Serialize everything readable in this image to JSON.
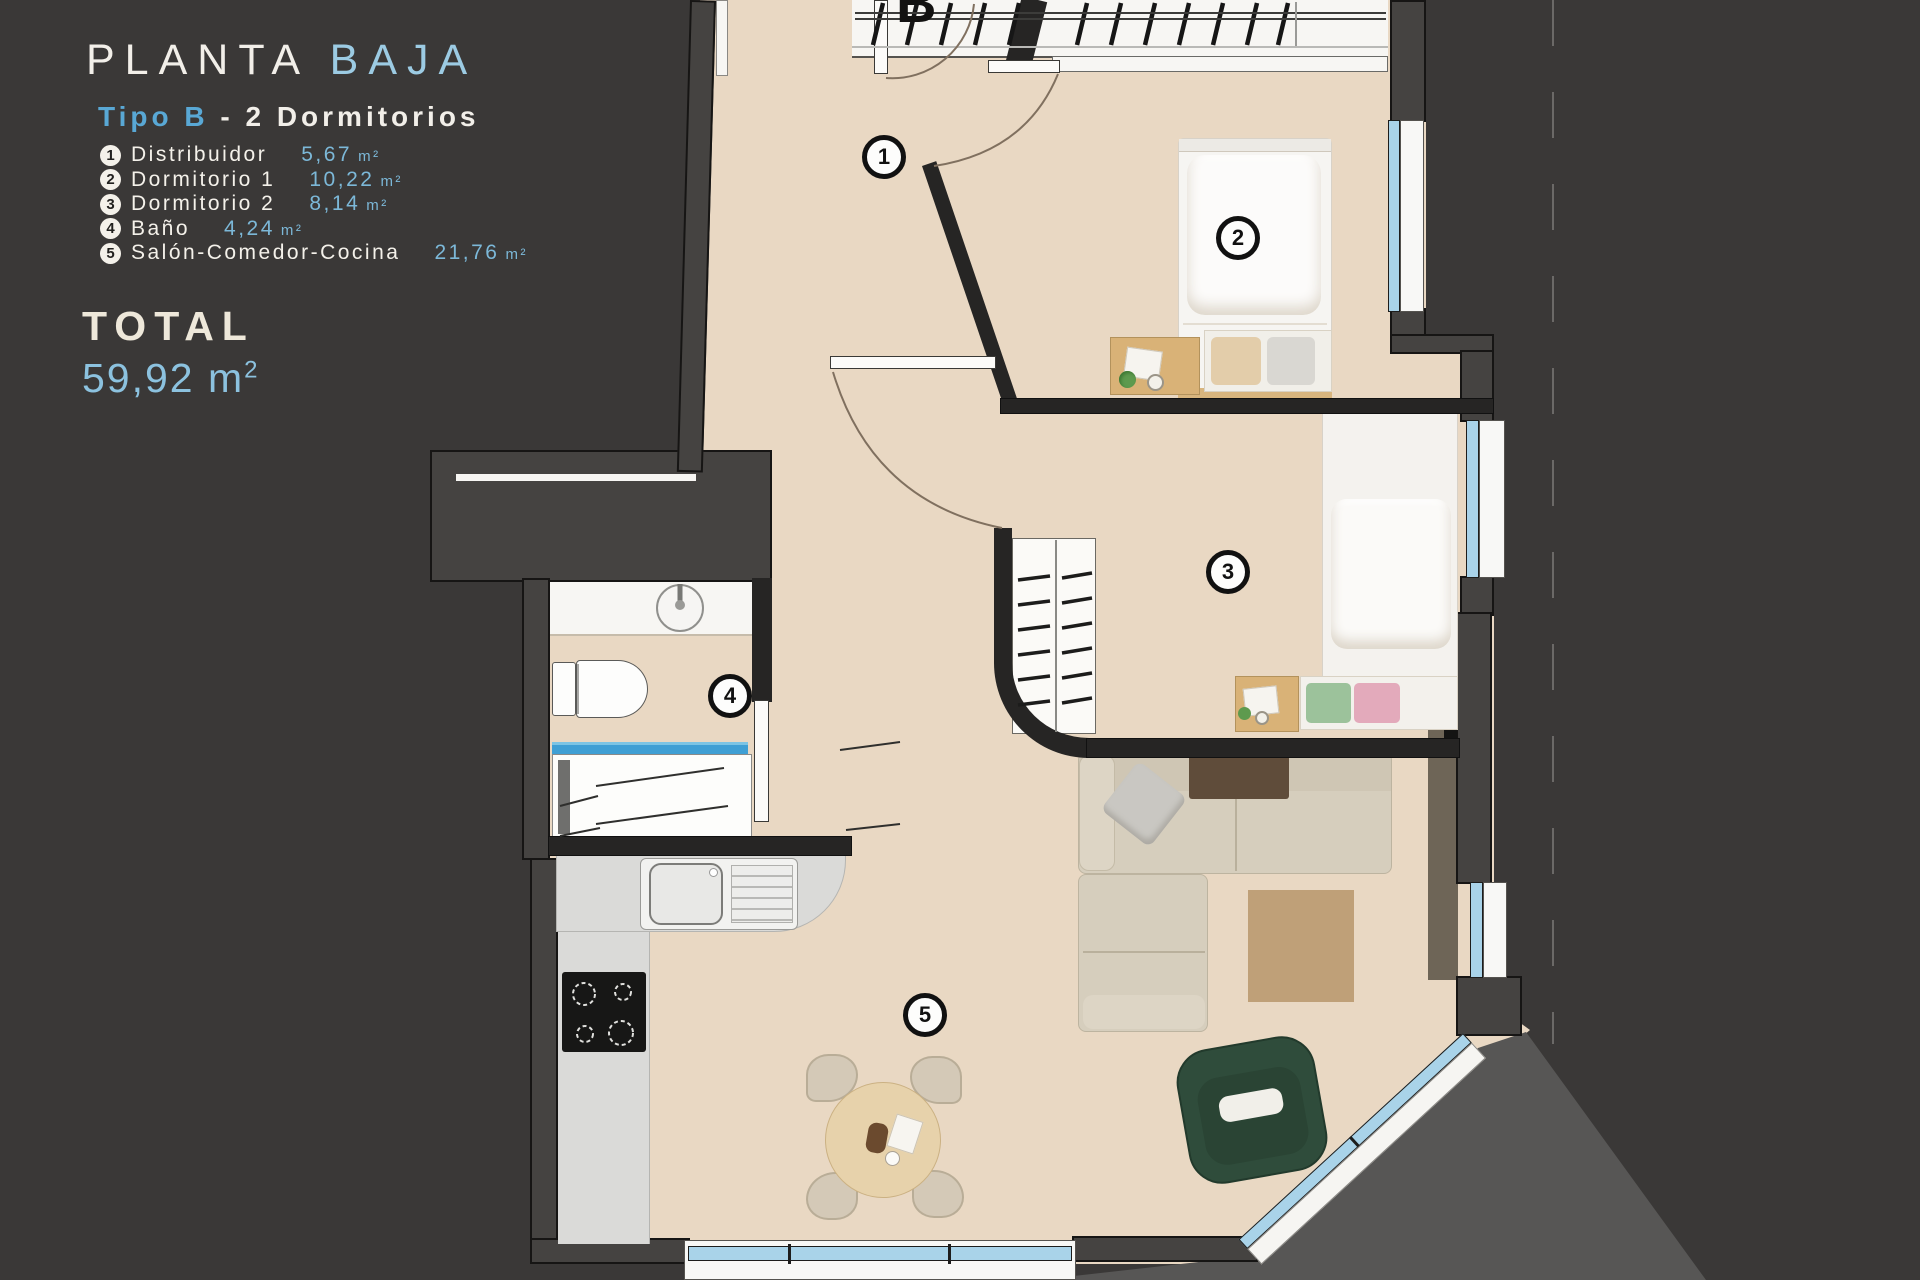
{
  "panel": {
    "title_primary": "PLANTA",
    "title_secondary": "BAJA",
    "subtitle_type": "Tipo B",
    "subtitle_rest": "- 2 Dormitorios",
    "legend": [
      {
        "number": "1",
        "name": "Distribuidor",
        "area": "5,67",
        "unit": "m²"
      },
      {
        "number": "2",
        "name": "Dormitorio 1",
        "area": "10,22",
        "unit": "m²"
      },
      {
        "number": "3",
        "name": "Dormitorio 2",
        "area": "8,14",
        "unit": "m²"
      },
      {
        "number": "4",
        "name": "Baño",
        "area": "4,24",
        "unit": "m²"
      },
      {
        "number": "5",
        "name": "Salón-Comedor-Cocina",
        "area": "21,76",
        "unit": "m²"
      }
    ],
    "total_label": "TOTAL",
    "total_value": "59,92",
    "total_unit_base": "m",
    "total_unit_sup": "2"
  },
  "plan": {
    "entrance_label": "B",
    "badges": [
      {
        "number": "1",
        "room": "Distribuidor"
      },
      {
        "number": "2",
        "room": "Dormitorio 1"
      },
      {
        "number": "3",
        "room": "Dormitorio 2"
      },
      {
        "number": "4",
        "room": "Baño"
      },
      {
        "number": "5",
        "room": "Salón-Comedor-Cocina"
      }
    ]
  },
  "colors": {
    "background": "#3a3837",
    "floor": "#e9d8c3",
    "accent_blue": "#7cb8d8",
    "accent_blue_light": "#9ccbe3",
    "text_white": "#f2efe9",
    "window_glass": "#a9d3e9",
    "armchair_green": "#2f4c3b",
    "rug_tan": "#bfa078"
  }
}
